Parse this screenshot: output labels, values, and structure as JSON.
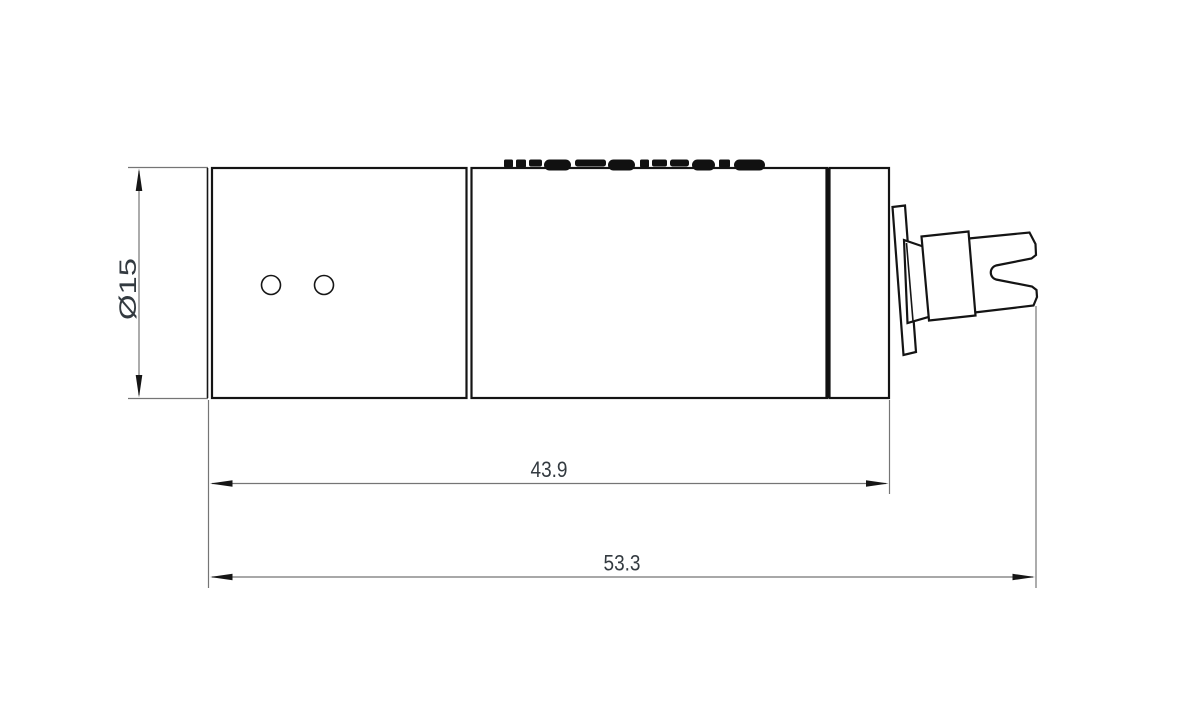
{
  "drawing": {
    "type": "engineering-drawing-side-view",
    "subject": "cylindrical body with stepped slotted output shaft",
    "background": "#ffffff",
    "colors": {
      "outline": "#141414",
      "dimension_line": "#757575",
      "dimension_text": "#333a40"
    },
    "dimensions": [
      {
        "id": "diameter",
        "label": "Ø15",
        "orientation": "vertical"
      },
      {
        "id": "body-length",
        "label": "43.9",
        "orientation": "horizontal"
      },
      {
        "id": "overall-length",
        "label": "53.3",
        "orientation": "horizontal"
      }
    ],
    "features": {
      "hole_count": 2,
      "engraving_legible": false
    },
    "engraving_fragments": [
      {
        "x": 504,
        "w": 9,
        "h": 8,
        "rx": 1.5
      },
      {
        "x": 516,
        "w": 10,
        "h": 8,
        "rx": 1.5
      },
      {
        "x": 529,
        "w": 13,
        "h": 7,
        "rx": 2
      },
      {
        "x": 544,
        "w": 27,
        "h": 11,
        "rx": 5.5
      },
      {
        "x": 575,
        "w": 31,
        "h": 7,
        "rx": 2.5
      },
      {
        "x": 608,
        "w": 27,
        "h": 11,
        "rx": 5.5
      },
      {
        "x": 640,
        "w": 9,
        "h": 8,
        "rx": 1.5
      },
      {
        "x": 652,
        "w": 15,
        "h": 7,
        "rx": 2
      },
      {
        "x": 670,
        "w": 19,
        "h": 7,
        "rx": 2.5
      },
      {
        "x": 692,
        "w": 23,
        "h": 11,
        "rx": 5.5
      },
      {
        "x": 719,
        "w": 11,
        "h": 8,
        "rx": 1.5
      },
      {
        "x": 734,
        "w": 31,
        "h": 11,
        "rx": 5.5
      }
    ]
  }
}
